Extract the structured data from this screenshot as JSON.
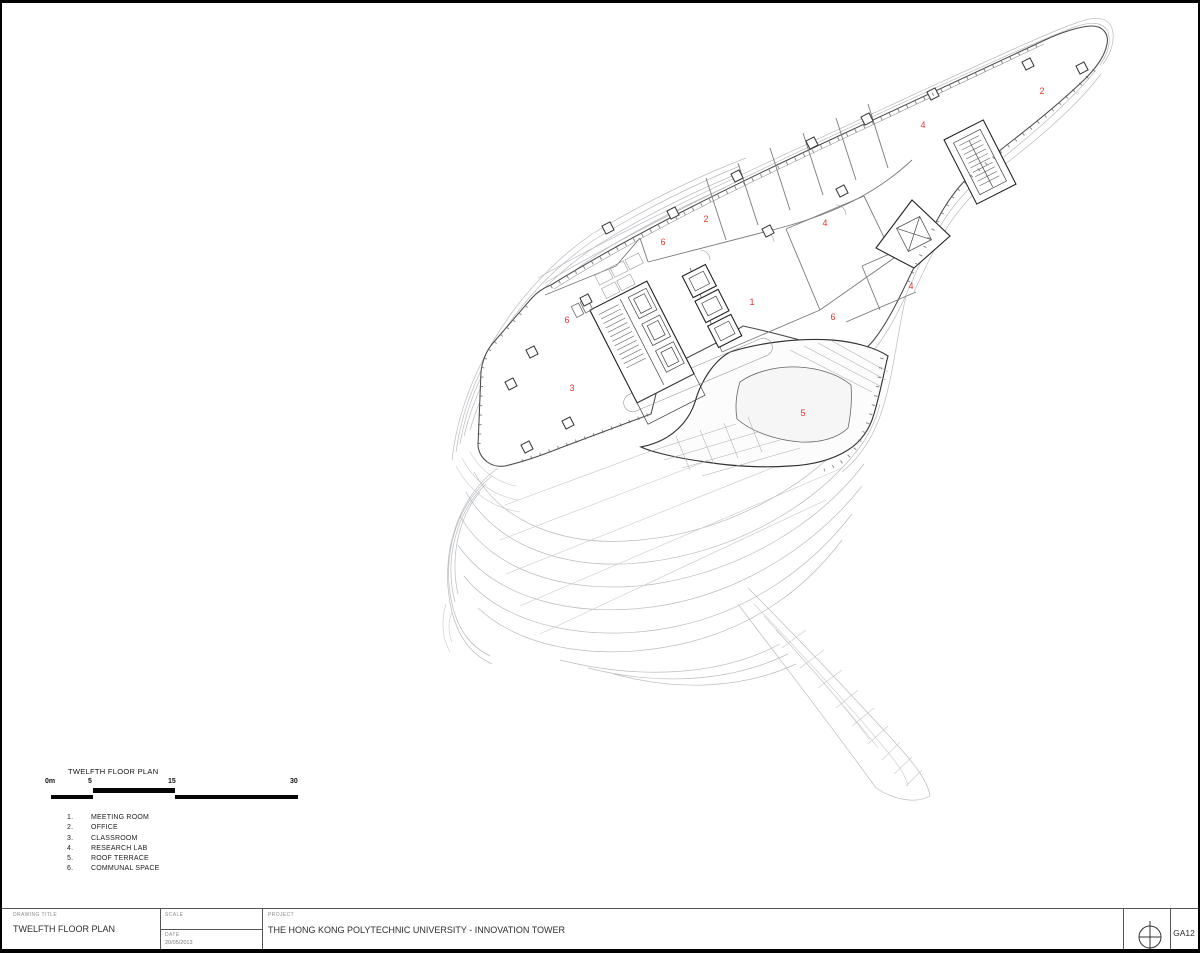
{
  "caption": {
    "title": "TWELFTH FLOOR PLAN",
    "scale_labels": [
      "0m",
      "5",
      "15",
      "30"
    ],
    "legend": [
      {
        "num": "1.",
        "label": "MEETING ROOM"
      },
      {
        "num": "2.",
        "label": "OFFICE"
      },
      {
        "num": "3.",
        "label": "CLASSROOM"
      },
      {
        "num": "4.",
        "label": "RESEARCH LAB"
      },
      {
        "num": "5.",
        "label": "ROOF TERRACE"
      },
      {
        "num": "6.",
        "label": "COMMUNAL SPACE"
      }
    ]
  },
  "plan": {
    "marker_color": "#e8312e",
    "markers": [
      {
        "n": "1",
        "x": 752,
        "y": 305
      },
      {
        "n": "2",
        "x": 1042,
        "y": 94
      },
      {
        "n": "2",
        "x": 706,
        "y": 222
      },
      {
        "n": "3",
        "x": 572,
        "y": 391
      },
      {
        "n": "4",
        "x": 923,
        "y": 128
      },
      {
        "n": "4",
        "x": 825,
        "y": 226
      },
      {
        "n": "4",
        "x": 911,
        "y": 289
      },
      {
        "n": "5",
        "x": 803,
        "y": 416
      },
      {
        "n": "6",
        "x": 663,
        "y": 245
      },
      {
        "n": "6",
        "x": 833,
        "y": 320
      },
      {
        "n": "6",
        "x": 567,
        "y": 323
      }
    ]
  },
  "titleblock": {
    "drawing_title_label": "DRAWING TITLE",
    "drawing_title": "TWELFTH FLOOR PLAN",
    "scale_label": "SCALE",
    "date_label": "DATE",
    "date_value": "20/05/2013",
    "project_label": "PROJECT",
    "project_title": "THE HONG KONG POLYTECHNIC UNIVERSITY - INNOVATION TOWER",
    "sheet_number": "GA12"
  }
}
